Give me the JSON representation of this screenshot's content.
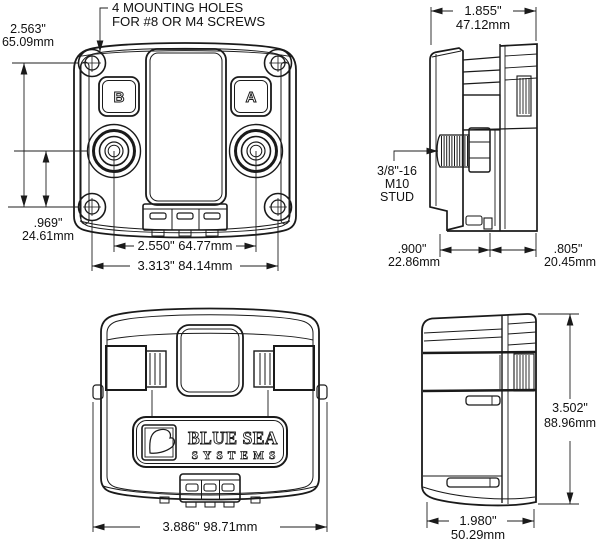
{
  "colors": {
    "line": "#1a1a1a",
    "text": "#111111",
    "background": "#ffffff"
  },
  "note": {
    "line1": "4 MOUNTING HOLES",
    "line2": "FOR #8 OR M4 SCREWS"
  },
  "front_view": {
    "button_b": "B",
    "button_a": "A",
    "dim_mount_height_in": "2.563\"",
    "dim_mount_height_mm": "65.09mm",
    "dim_stud_offset_in": ".969\"",
    "dim_stud_offset_mm": "24.61mm",
    "dim_stud_spacing": "2.550\" 64.77mm",
    "dim_mount_spacing": "3.313\" 84.14mm"
  },
  "side_view_upper": {
    "dim_width_in": "1.855\"",
    "dim_width_mm": "47.12mm",
    "stud_line1": "3/8\"-16",
    "stud_line2": "M10",
    "stud_line3": "STUD",
    "dim_rear_depth_in": ".900\"",
    "dim_rear_depth_mm": "22.86mm",
    "dim_front_depth_in": ".805\"",
    "dim_front_depth_mm": "20.45mm"
  },
  "rear_view": {
    "logo_line1": "BLUE SEA",
    "logo_line2": "SYSTEMS",
    "dim_width": "3.886\" 98.71mm"
  },
  "side_view_lower": {
    "dim_height_in": "3.502\"",
    "dim_height_mm": "88.96mm",
    "dim_depth_in": "1.980\"",
    "dim_depth_mm": "50.29mm"
  }
}
